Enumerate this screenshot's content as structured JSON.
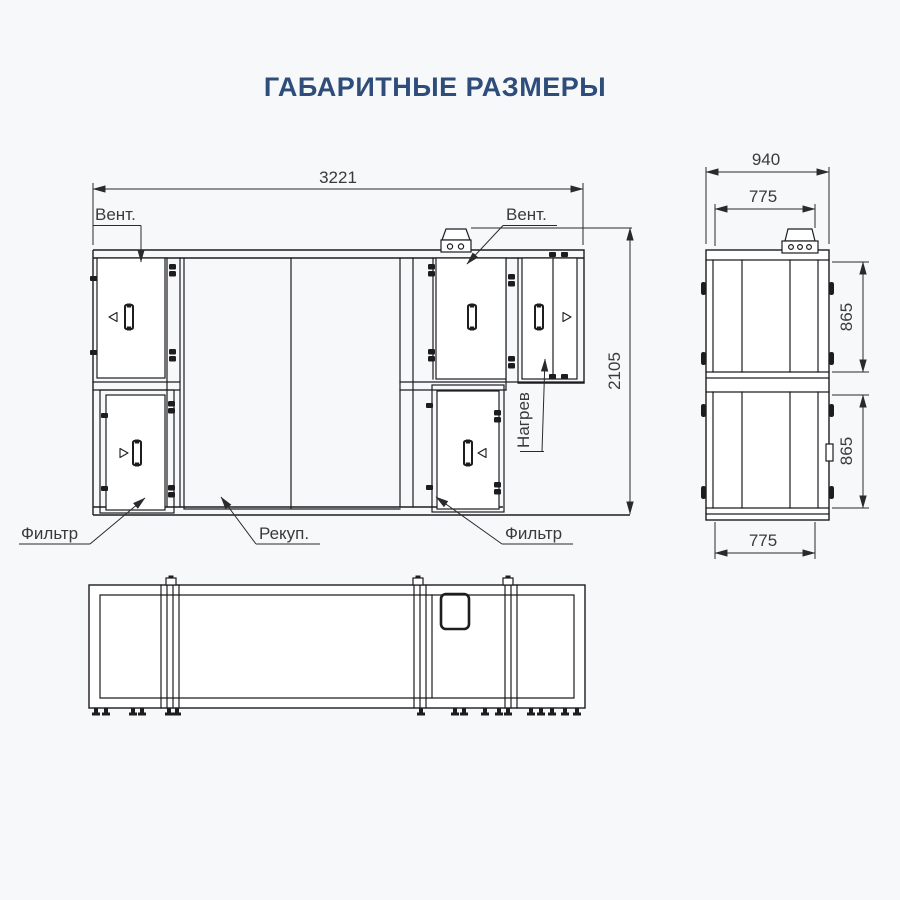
{
  "title": "ГАБАРИТНЫЕ РАЗМЕРЫ",
  "colors": {
    "accent": "#2E4D7B",
    "line": "#1D1D20",
    "dim_text": "#3A3A3C",
    "background": "#F6F8FA"
  },
  "front_view": {
    "dim_width": "3221",
    "dim_height": "2105",
    "label_fan_left": "Вент.",
    "label_fan_right": "Вент.",
    "label_heater": "Нагрев",
    "label_filter_left": "Фильтр",
    "label_recuperator": "Рекуп.",
    "label_filter_right": "Фильтр"
  },
  "side_view": {
    "dim_overall_width": "940",
    "dim_top_width": "775",
    "dim_upper_height": "865",
    "dim_lower_height": "865",
    "dim_bottom_width": "775"
  }
}
